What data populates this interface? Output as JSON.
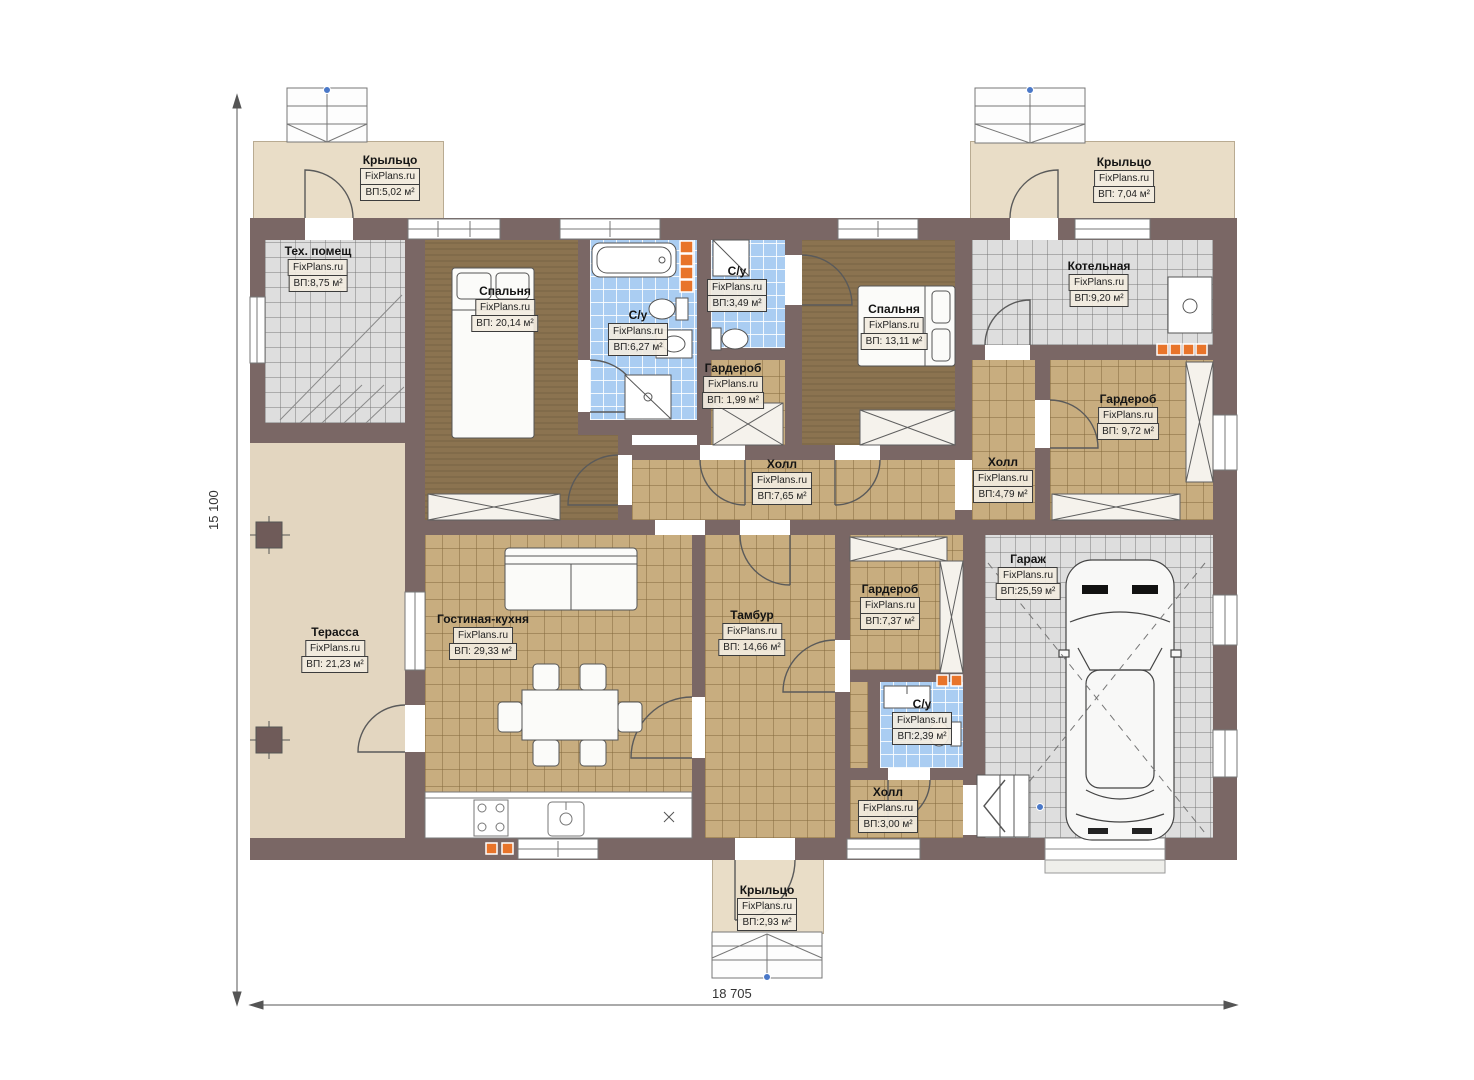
{
  "brand": "FixPlans.ru",
  "plan": {
    "type": "single-storey house floor plan",
    "overall_width_label": "18 705",
    "overall_height_label": "15 100"
  },
  "rooms": [
    {
      "id": "porch-top-left",
      "name": "Крыльцо",
      "watermark": "FixPlans.ru",
      "area": "ВП:5,02 м²"
    },
    {
      "id": "tech-room",
      "name": "Тех. помещ",
      "watermark": "FixPlans.ru",
      "area": "ВП:8,75 м²"
    },
    {
      "id": "bedroom-1",
      "name": "Спальня",
      "watermark": "FixPlans.ru",
      "area": "ВП: 20,14 м²"
    },
    {
      "id": "bathroom-1",
      "name": "С/у",
      "watermark": "FixPlans.ru",
      "area": "ВП:6,27 м²"
    },
    {
      "id": "bathroom-2",
      "name": "С/у",
      "watermark": "FixPlans.ru",
      "area": "ВП:3,49 м²"
    },
    {
      "id": "wardrobe-small",
      "name": "Гардероб",
      "watermark": "FixPlans.ru",
      "area": "ВП: 1,99 м²"
    },
    {
      "id": "bedroom-2",
      "name": "Спальня",
      "watermark": "FixPlans.ru",
      "area": "ВП: 13,11 м²"
    },
    {
      "id": "boiler-room",
      "name": "Котельная",
      "watermark": "FixPlans.ru",
      "area": "ВП:9,20 м²"
    },
    {
      "id": "porch-top-right",
      "name": "Крыльцо",
      "watermark": "FixPlans.ru",
      "area": "ВП: 7,04 м²"
    },
    {
      "id": "wardrobe-right",
      "name": "Гардероб",
      "watermark": "FixPlans.ru",
      "area": "ВП: 9,72 м²"
    },
    {
      "id": "hall-small",
      "name": "Холл",
      "watermark": "FixPlans.ru",
      "area": "ВП:4,79 м²"
    },
    {
      "id": "hall-main",
      "name": "Холл",
      "watermark": "FixPlans.ru",
      "area": "ВП:7,65 м²"
    },
    {
      "id": "terrace",
      "name": "Терасса",
      "watermark": "FixPlans.ru",
      "area": "ВП: 21,23 м²"
    },
    {
      "id": "living-kitchen",
      "name": "Гостиная-кухня",
      "watermark": "FixPlans.ru",
      "area": "ВП: 29,33 м²"
    },
    {
      "id": "tambour",
      "name": "Тамбур",
      "watermark": "FixPlans.ru",
      "area": "ВП: 14,66 м²"
    },
    {
      "id": "wardrobe-mid",
      "name": "Гардероб",
      "watermark": "FixPlans.ru",
      "area": "ВП:7,37 м²"
    },
    {
      "id": "bathroom-3",
      "name": "С/у",
      "watermark": "FixPlans.ru",
      "area": "ВП:2,39 м²"
    },
    {
      "id": "hall-entry",
      "name": "Холл",
      "watermark": "FixPlans.ru",
      "area": "ВП:3,00 м²"
    },
    {
      "id": "garage",
      "name": "Гараж",
      "watermark": "FixPlans.ru",
      "area": "ВП:25,59 м²"
    },
    {
      "id": "porch-bottom",
      "name": "Крыльцо",
      "watermark": "FixPlans.ru",
      "area": "ВП:2,93 м²"
    }
  ],
  "dimensions": {
    "bottom": "18 705",
    "left": "15 100"
  },
  "colors": {
    "wall": "#7A6765",
    "floor_tan": "#C8AD7F",
    "floor_brown": "#8B7350",
    "bathroom_blue": "#AACDF2",
    "tile_gray": "#DEDEDE",
    "porch_beige": "#E9DDC7",
    "vent_orange": "#E8742A",
    "marker_blue": "#4A78C8"
  }
}
